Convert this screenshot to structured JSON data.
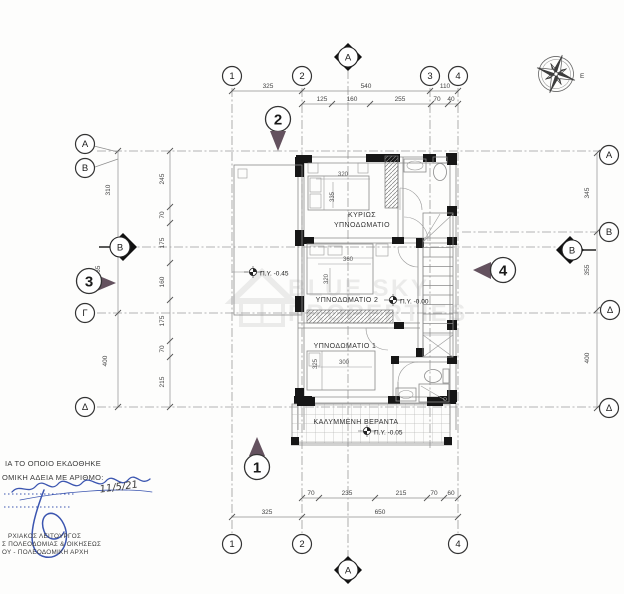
{
  "drawing": {
    "rooms": {
      "main_bedroom_line1": "ΚΥΡΙΩΣ",
      "main_bedroom_line2": "ΥΠΝΟΔΩΜΑΤΙΟ",
      "bedroom2": "ΥΠΝΟΔΩΜΑΤΙΟ 2",
      "bedroom1": "ΥΠΝΟΔΩΜΑΤΙΟ 1",
      "veranda": "ΚΑΛΥΜΜΕΝΗ ΒΕΡΑΝΤΑ"
    },
    "levels": {
      "terrace": "Π.Υ. -0.45",
      "floor": "Π.Υ. -0.00",
      "veranda": "Π.Υ. -0.05"
    },
    "grid": {
      "top": [
        "1",
        "2",
        "3",
        "4"
      ],
      "bottom": [
        "1",
        "2",
        "4"
      ],
      "left": [
        "A",
        "B",
        "Γ",
        "Δ"
      ],
      "right": [
        "A",
        "B",
        "Δ",
        "Δ"
      ]
    },
    "sections": {
      "top": "A",
      "bottom": "A",
      "left": "B",
      "right": "B"
    },
    "views": {
      "v1": "1",
      "v2": "2",
      "v3": "3",
      "v4": "4"
    },
    "dims": {
      "top_main": [
        "325",
        "540",
        "110"
      ],
      "top_sub": [
        "125",
        "160",
        "255",
        "70",
        "40"
      ],
      "bottom_sub": [
        "70",
        "235",
        "215",
        "70",
        "60"
      ],
      "bottom_main": [
        "325",
        "650"
      ],
      "left_outer": [
        "310",
        "400"
      ],
      "left_inner": [
        "245",
        "70",
        "175",
        "160",
        "175",
        "70",
        "215"
      ],
      "left_extra": "365",
      "right_col": [
        "345",
        "355",
        "400"
      ],
      "bed_main_w": "320",
      "bed_main_h": "335",
      "bed2_w": "360",
      "bed2_h": "320",
      "bed1_h": "325",
      "bed1_w": "300"
    },
    "compass_label": "Ε",
    "watermark": {
      "line1": "BLUE SKY",
      "line2": "PROPERTIES"
    },
    "stamp": {
      "line1": "ΙΑ ΤΟ ΟΠΟΙΟ ΕΚΔΟΘΗΚΕ",
      "line2": "ΟΜΙΚΗ ΑΔΕΙΑ ΜΕ ΑΡΙΘΜΟ:",
      "date": "11/5/21",
      "line3": "ΡΧΙΑΚΟΣ ΛΕΙΤΟΥΡΓΟΣ",
      "line4": "Σ ΠΟΛΕΟΔΟΜΙΑΣ & ΟΙΚΗΣΕΩΣ",
      "line5": "ΟΥ - ΠΟΛΕΟΔΟΜΙΚΗ ΑΡΧΗ",
      "color": "#3b55b0"
    }
  }
}
